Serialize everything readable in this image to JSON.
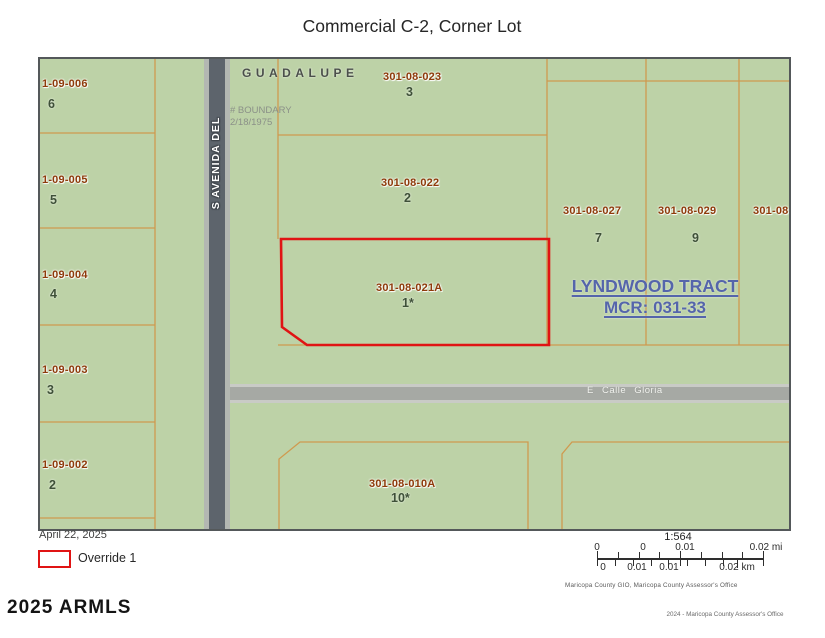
{
  "title": "Commercial C-2, Corner Lot",
  "map": {
    "streets": {
      "vertical": "S AVENIDA DEL",
      "top": "GUADALUPE",
      "horizontal": "E Calle Gloria"
    },
    "boundary_note": {
      "line1": "# BOUNDARY",
      "line2": "2/18/1975"
    },
    "tract": {
      "line1": "LYNDWOOD TRACT",
      "line2": "MCR: 031-33"
    },
    "parcels": [
      {
        "apn": "1-09-006",
        "lot": "6",
        "ax": 2,
        "ay": 20,
        "lx": 8,
        "ly": 39
      },
      {
        "apn": "1-09-005",
        "lot": "5",
        "ax": 2,
        "ay": 116,
        "lx": 10,
        "ly": 135
      },
      {
        "apn": "1-09-004",
        "lot": "4",
        "ax": 2,
        "ay": 211,
        "lx": 10,
        "ly": 229
      },
      {
        "apn": "1-09-003",
        "lot": "3",
        "ax": 2,
        "ay": 306,
        "lx": 7,
        "ly": 325
      },
      {
        "apn": "1-09-002",
        "lot": "2",
        "ax": 2,
        "ay": 401,
        "lx": 9,
        "ly": 420
      },
      {
        "apn": "301-08-023",
        "lot": "3",
        "ax": 343,
        "ay": 13,
        "lx": 366,
        "ly": 27
      },
      {
        "apn": "301-08-022",
        "lot": "2",
        "ax": 341,
        "ay": 119,
        "lx": 364,
        "ly": 133
      },
      {
        "apn": "301-08-021A",
        "lot": "1*",
        "ax": 336,
        "ay": 224,
        "lx": 362,
        "ly": 238
      },
      {
        "apn": "301-08-027",
        "lot": "7",
        "ax": 523,
        "ay": 147,
        "lx": 555,
        "ly": 173
      },
      {
        "apn": "301-08-029",
        "lot": "9",
        "ax": 618,
        "ay": 147,
        "lx": 652,
        "ly": 173
      },
      {
        "apn": "301-08-0",
        "lot": "",
        "ax": 713,
        "ay": 147,
        "lx": 0,
        "ly": 0
      },
      {
        "apn": "301-08-010A",
        "lot": "10*",
        "ax": 329,
        "ay": 420,
        "lx": 351,
        "ly": 433
      }
    ]
  },
  "footer": {
    "date": "April 22, 2025",
    "legend_label": "Override 1",
    "scale_ratio": "1:564",
    "scale_mi_labels": [
      "0",
      "0",
      "0.01",
      "0.02 mi"
    ],
    "scale_km_labels": [
      "0",
      "0.01",
      "0.01",
      "0.02 km"
    ],
    "credit": "Maricopa County GIO, Maricopa County Assessor's Office",
    "copyright": "2024 - Maricopa County Assessor's Office",
    "watermark": "2025 ARMLS"
  },
  "colors": {
    "parcel_green": "#bdd2a7",
    "boundary_orange": "#cf9a4f",
    "apn_brown": "#8e3a0a",
    "lot_green": "#3e5038",
    "tract_blue": "#5565ab",
    "override_red": "#e01414",
    "road_dark": "#5d646c",
    "road_light": "#b3b7b2",
    "cross_road_gray": "#a6a9a4"
  }
}
